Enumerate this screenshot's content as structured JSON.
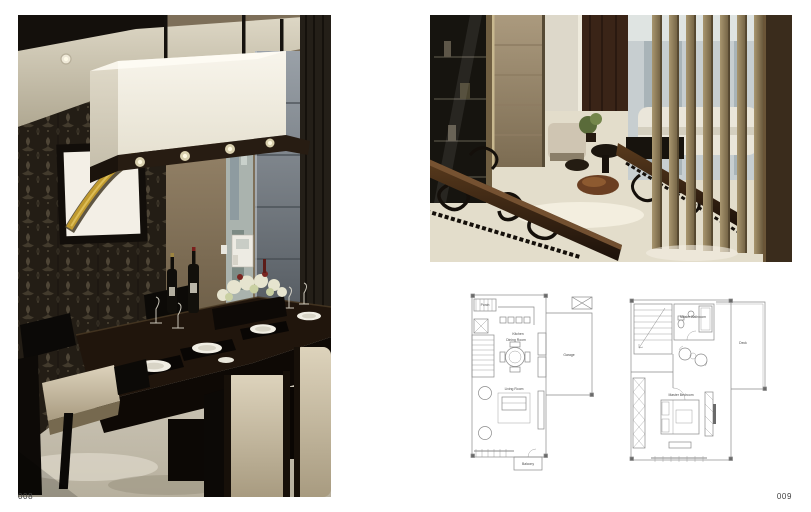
{
  "spread": {
    "left_page_number": "008",
    "right_page_number": "009"
  },
  "plans": {
    "plan_a": {
      "labels": {
        "porch": "Porch",
        "kitchen": "Kitchen",
        "dining": "Dining Room",
        "garage": "Garage",
        "living": "Living Room",
        "balcony": "Balcony"
      }
    },
    "plan_b": {
      "labels": {
        "bath": "Master Bathroom",
        "deck": "Deck",
        "bedroom": "Master Bedroom"
      }
    }
  },
  "colors": {
    "paper": "#ffffff",
    "page_number": "#3f3f3f",
    "plan_line": "#8a8a8a"
  }
}
